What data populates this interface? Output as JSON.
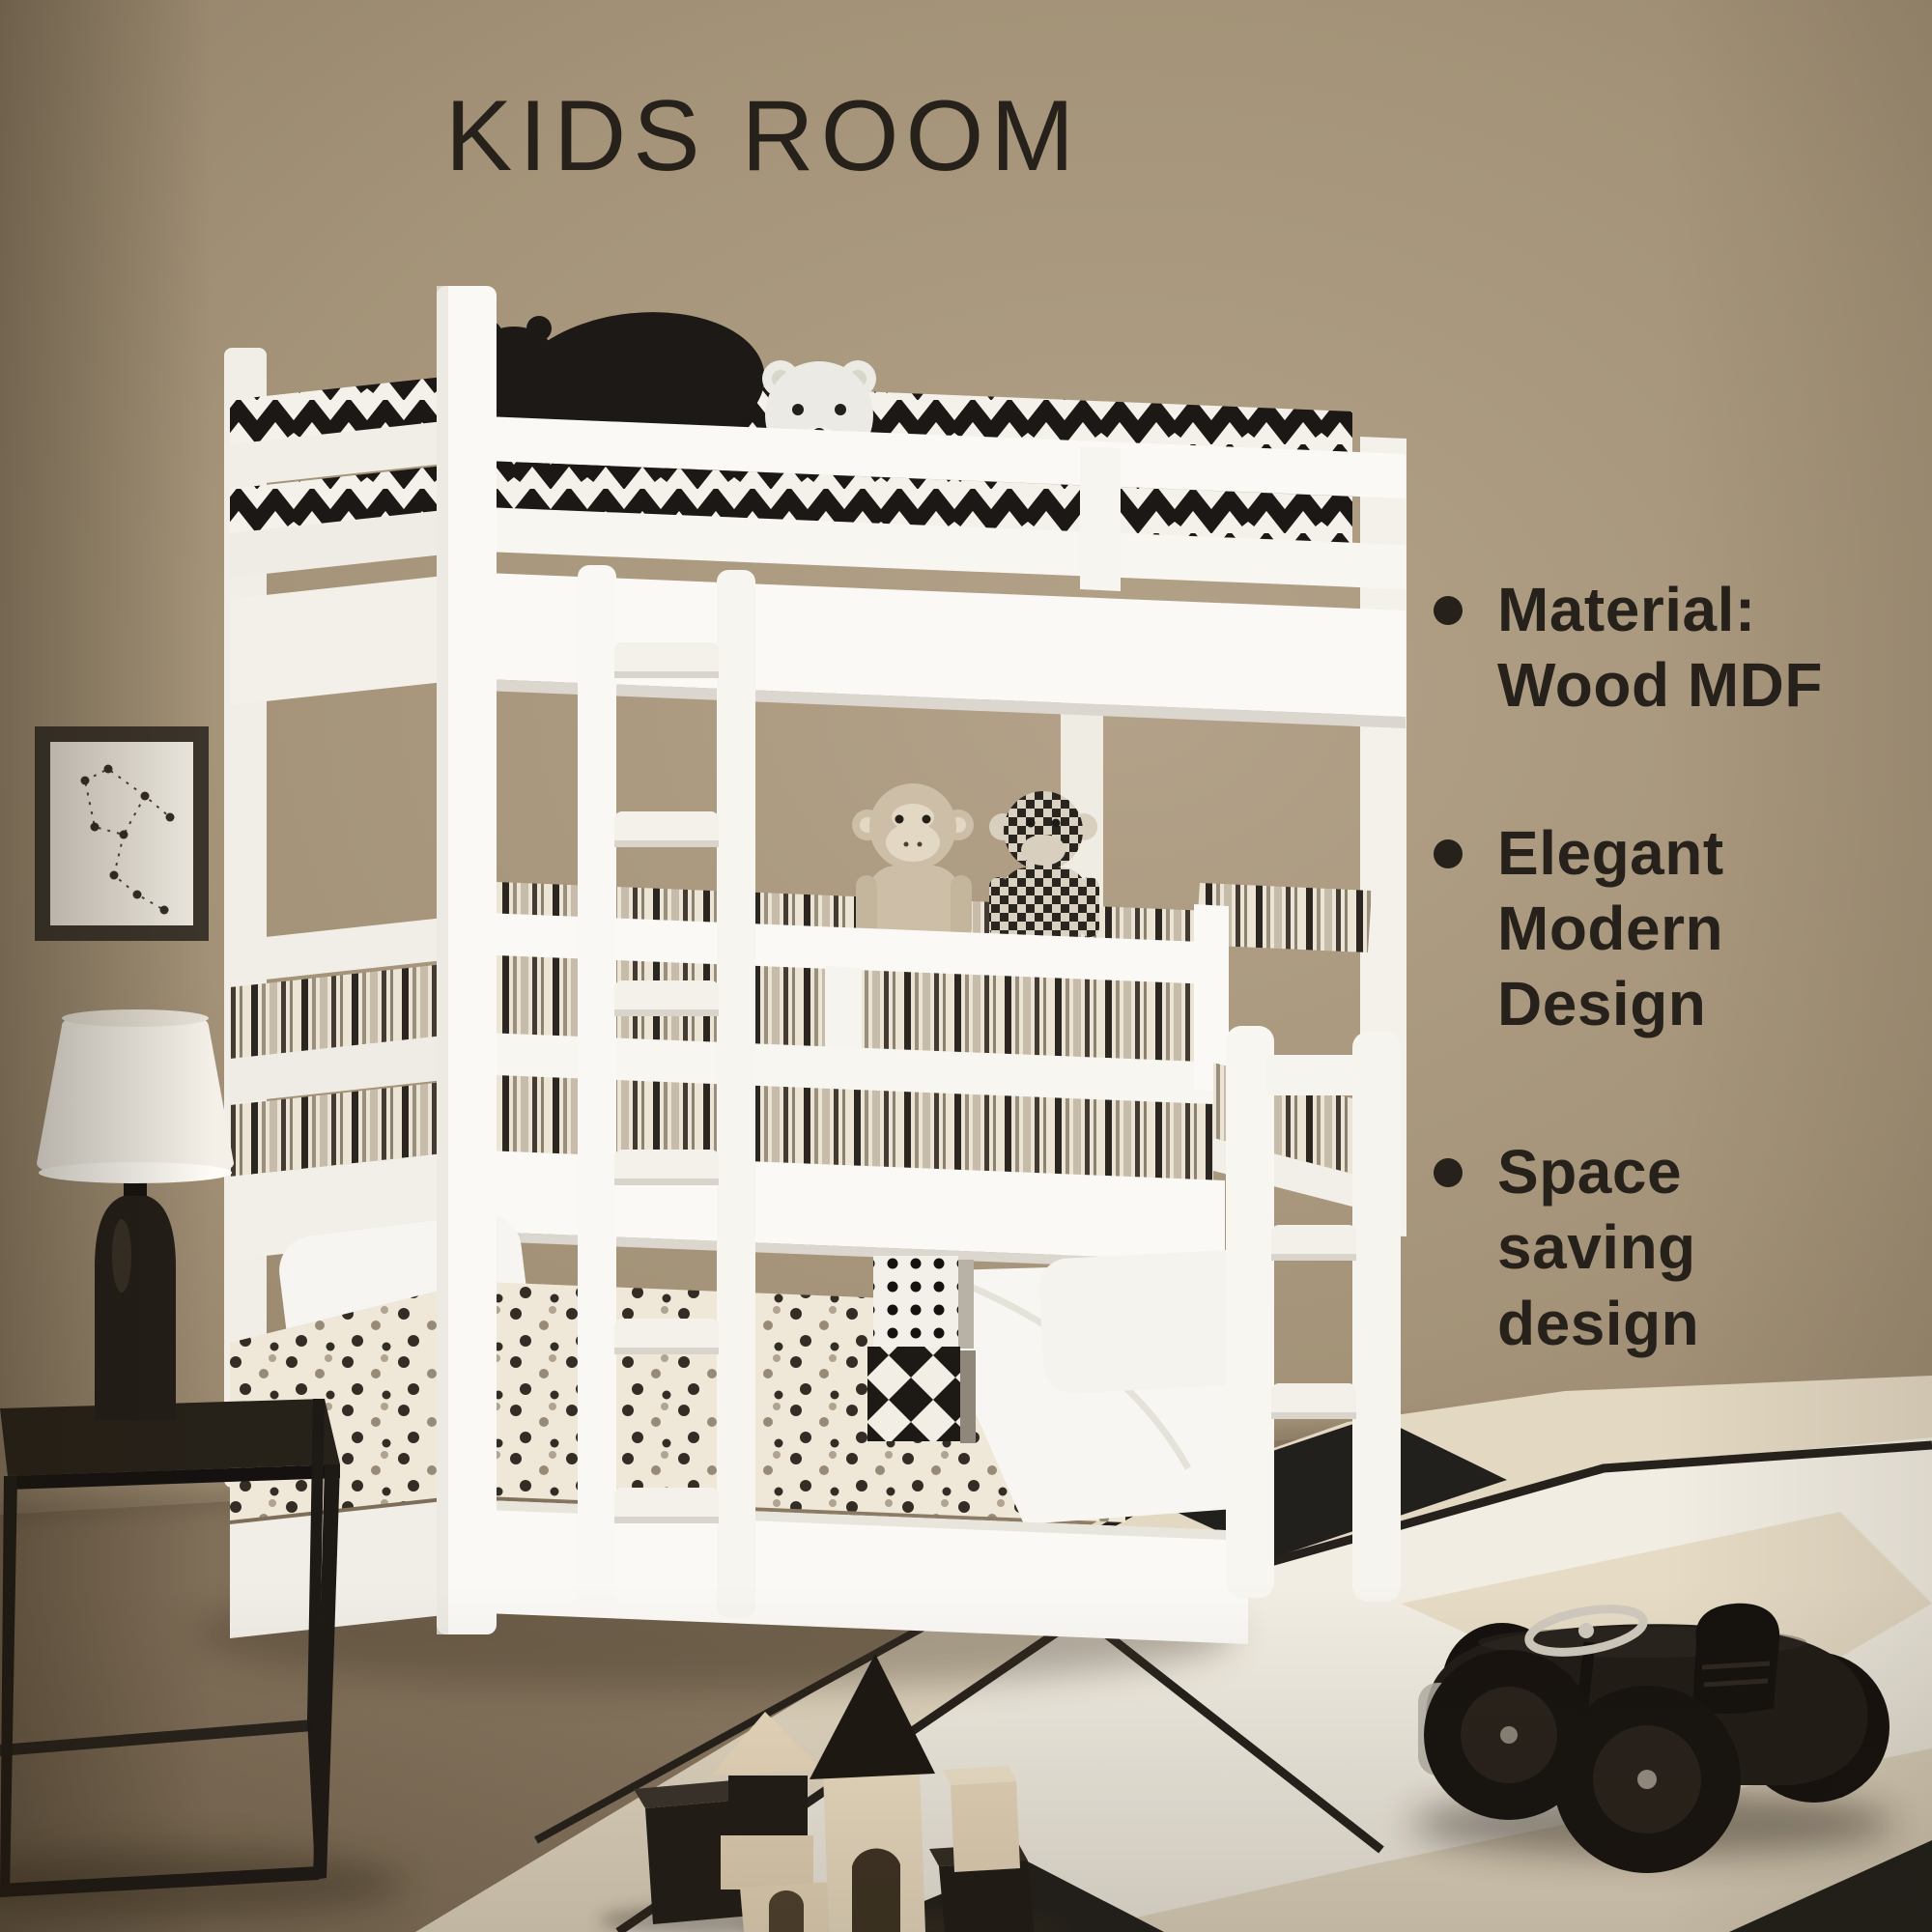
{
  "title": "KIDS ROOM",
  "features": [
    {
      "text": "Material:\nWood MDF"
    },
    {
      "text": "Elegant\nModern\nDesign"
    },
    {
      "text": "Space\nsaving\ndesign"
    }
  ],
  "palette": {
    "wall": "#a49378",
    "wall_dark": "#6e5e46",
    "floor": "#8e7d66",
    "bed_white": "#f9f7f3",
    "text": "#26211a",
    "rug_base": "#e3d8c2",
    "rug_white": "#f2ede2",
    "toy_black": "#211c17",
    "toy_wood": "#ead9bc"
  }
}
